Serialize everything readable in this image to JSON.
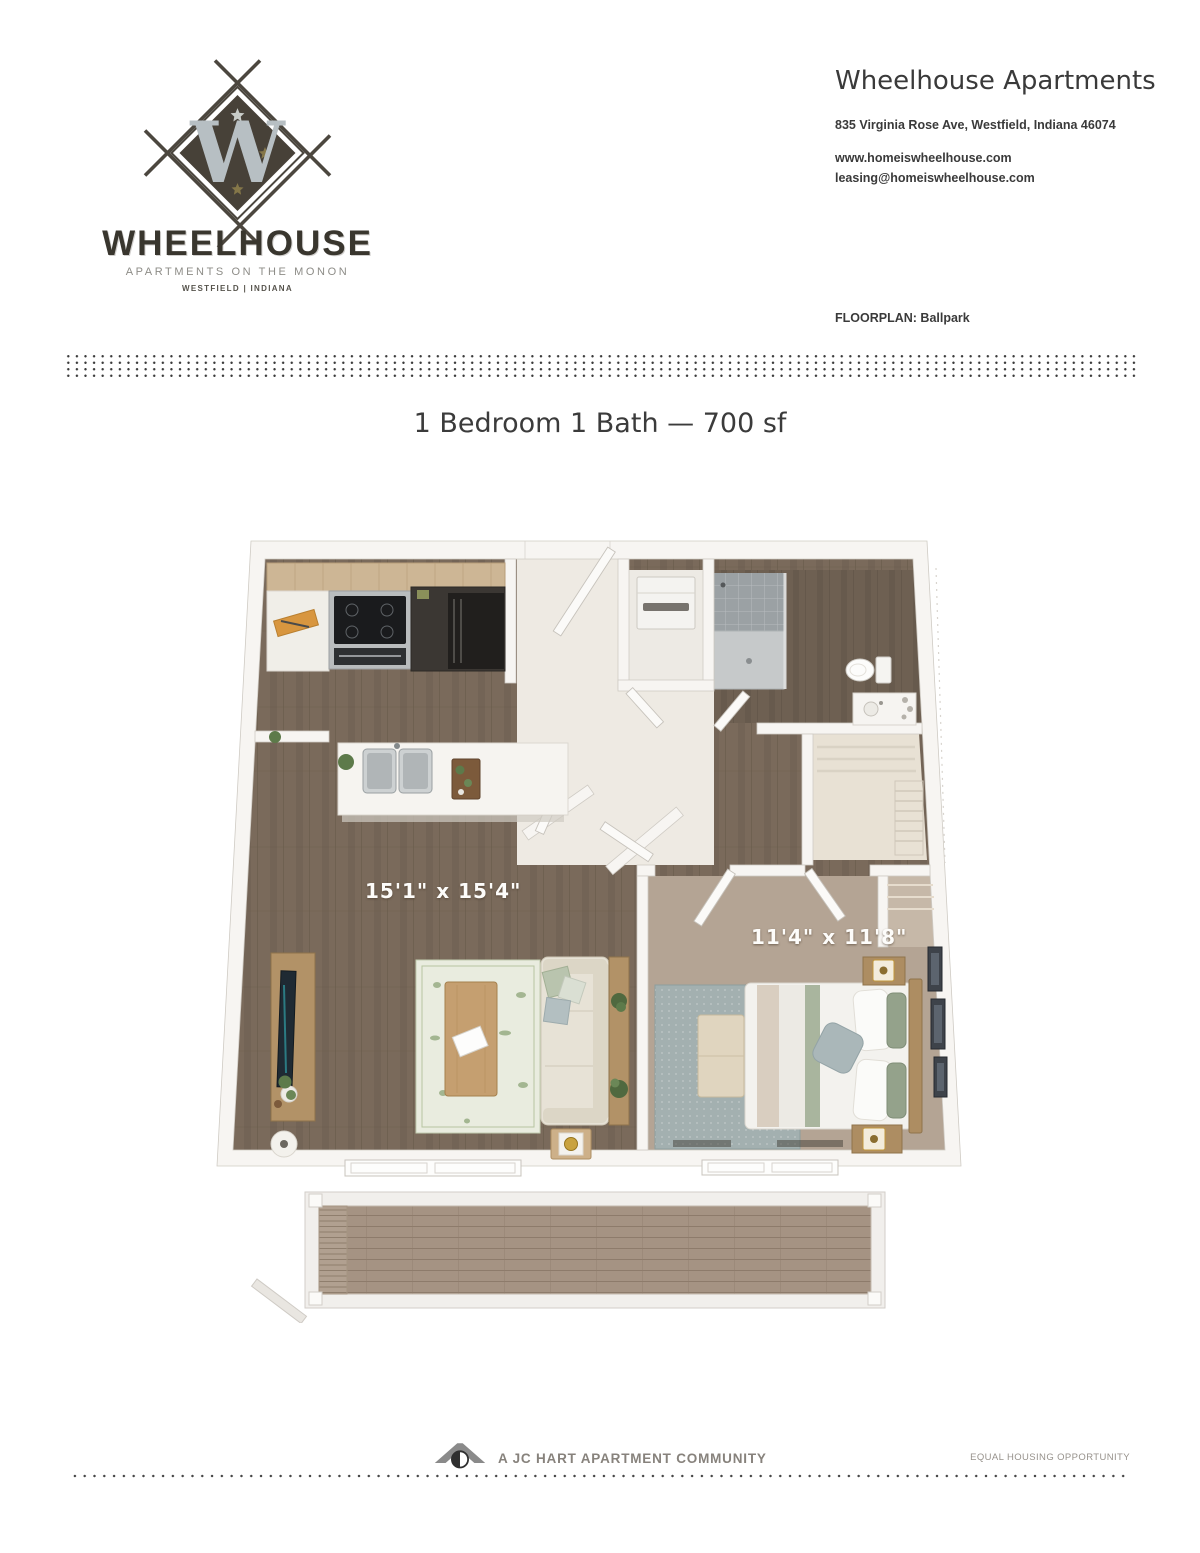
{
  "brand": {
    "monogram": "W",
    "wordmark": "WHEELHOUSE",
    "tagline": "APARTMENTS ON THE MONON",
    "location": "WESTFIELD | INDIANA"
  },
  "header": {
    "title": "Wheelhouse Apartments",
    "address": "835 Virginia Rose Ave, Westfield, Indiana 46074",
    "website": "www.homeiswheelhouse.com",
    "email": "leasing@homeiswheelhouse.com",
    "floorplan_label": "FLOORPLAN:",
    "floorplan_name": "Ballpark"
  },
  "floorplan": {
    "title": "1 Bedroom 1 Bath — 700 sf",
    "living_room_dimensions": "15'1\" x 15'4\"",
    "bedroom_dimensions": "11'4\" x 11'8\""
  },
  "footer": {
    "community_line": "A JC HART APARTMENT COMMUNITY",
    "equal_housing": "EQUAL HOUSING OPPORTUNITY"
  },
  "colors": {
    "logo_dark": "#474138",
    "logo_monogram": "#b7bfc3",
    "star_gold": "#857749",
    "text_dark": "#3a3a3a",
    "text_gray": "#8d8c87",
    "wood_floor": "#7a6a5b",
    "bathroom_floor": "#6e6052",
    "bedroom_carpet": "#b4a494",
    "cabinet_wood": "#cdb695",
    "deck_wood": "#a59383",
    "living_rug": "#e9ecdf",
    "bedroom_rug": "#a3b0b0",
    "wall_white": "#f7f5f2"
  }
}
